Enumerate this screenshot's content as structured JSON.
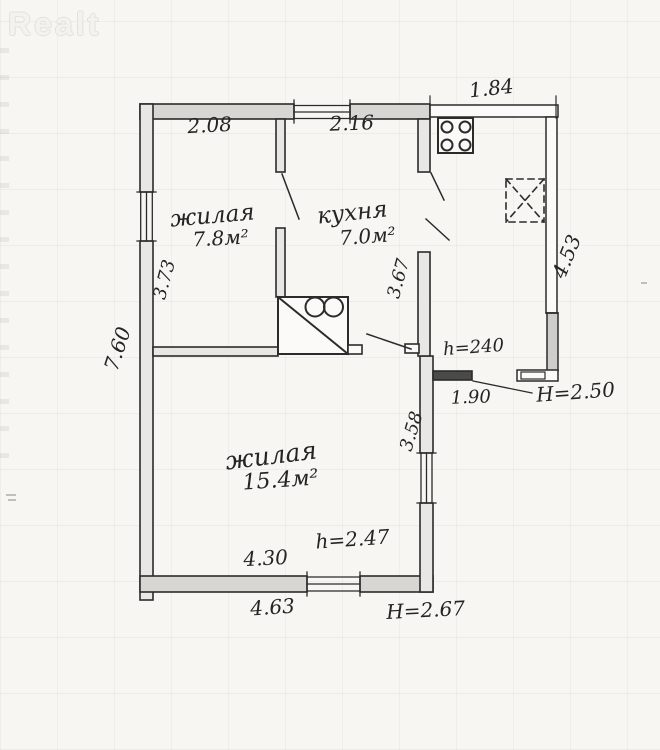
{
  "watermark": {
    "logo": "Realt"
  },
  "rooms": {
    "living_small": {
      "label": "жилая",
      "area": "7.8м²"
    },
    "kitchen": {
      "label": "кухня",
      "area": "7.0м²"
    },
    "living_large": {
      "label": "жилая",
      "area": "15.4м²"
    }
  },
  "dims": {
    "top_left_room_width": "2.08",
    "kitchen_width": "2.16",
    "porch_width": "1.84",
    "left_room_depth": "3.73",
    "house_depth": "7.60",
    "kitchen_depth": "3.67",
    "porch_depth": "4.53",
    "porch_ceiling": "h=240",
    "porch_opening": "1.90",
    "porch_height": "H=2.50",
    "large_room_right_depth": "3.58",
    "large_room_ceiling": "h=2.47",
    "large_room_width": "4.30",
    "house_width": "4.63",
    "house_height": "H=2.67"
  },
  "colors": {
    "ink": "#2b2b2b",
    "paper": "#f7f6f3",
    "wall_fill": "#d8d6d2"
  }
}
